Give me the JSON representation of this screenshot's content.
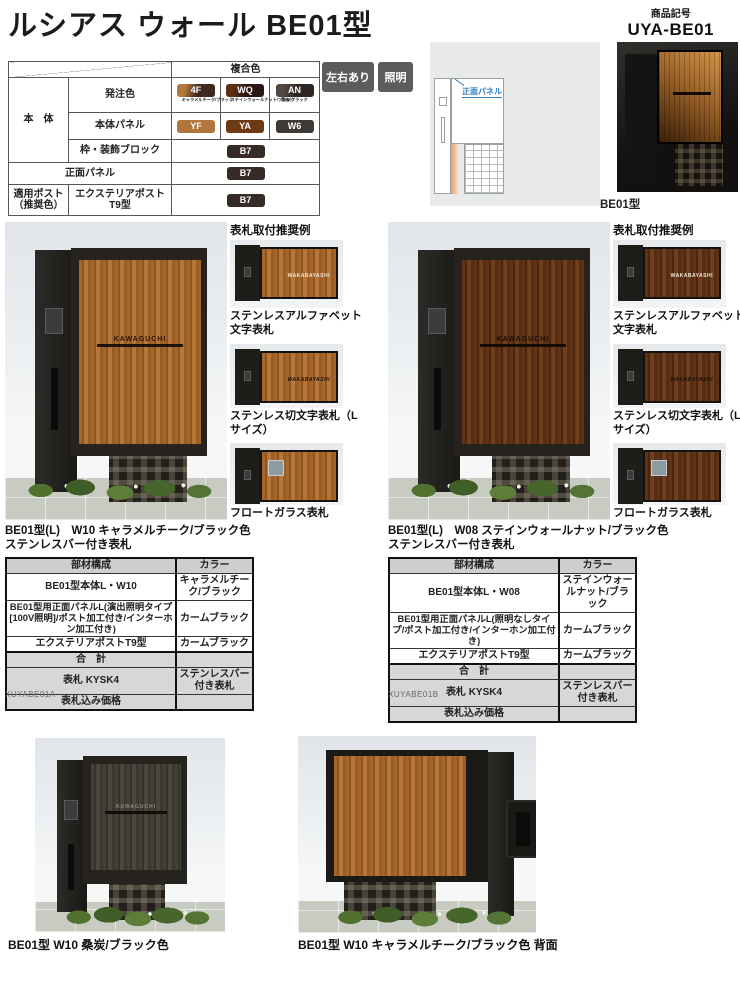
{
  "header": {
    "title": "ルシアス ウォール BE01型",
    "product_code_label": "商品記号",
    "product_code": "UYA-BE01"
  },
  "spec_table": {
    "composite_header": "複合色",
    "body_label": "本　体",
    "order_color_label": "発注色",
    "body_panel_label": "本体パネル",
    "frame_block_label": "枠・装飾ブロック",
    "front_panel_label": "正面パネル",
    "post_row_label": "適用ポスト（推奨色）",
    "post_model": "エクステリアポスト T9型",
    "order_colors": [
      {
        "code": "4F",
        "name": "キャラメルチーク/ブラック",
        "chip": "#3c2a1e"
      },
      {
        "code": "WQ",
        "name": "ステインウォールナット/ブラック",
        "chip": "#281712"
      },
      {
        "code": "AN",
        "name": "桑炭/ブラック",
        "chip": "#2e2724"
      }
    ],
    "panel_colors": [
      {
        "code": "YF",
        "chip": "#b0763c"
      },
      {
        "code": "YA",
        "chip": "#6e3a14"
      },
      {
        "code": "W6",
        "chip": "#3f3a36"
      }
    ],
    "block_color": {
      "code": "B7",
      "chip": "#362b26"
    }
  },
  "tags": [
    {
      "label": "左右あり"
    },
    {
      "label": "照明"
    }
  ],
  "lighting": {
    "diagram_label": "正面パネル",
    "title": "演出照明タイプ",
    "badge_100v": "100Vタイプ",
    "badge_100v_color": "#ef9350",
    "badge_24v": "24Vタイプ",
    "badge_24v_color": "#6cb52f"
  },
  "hero_caption": "BE01型",
  "nameplate_example_title": "表札取付推奨例",
  "nameplate_demo_text": "WAKABAYASHI",
  "photo_nameplate_text": "KAWAGUCHI",
  "sections": [
    {
      "caption_line1": "BE01型(L)　W10 キャラメルチーク/ブラック色",
      "caption_line2": "ステンレスバー付き表札",
      "thumbs": [
        "ステンレスアルファベット文字表札",
        "ステンレス切文字表札（Lサイズ）",
        "フロートガラス表札"
      ],
      "table": {
        "headers": [
          "部材構成",
          "カラー"
        ],
        "rows": [
          {
            "part": "BE01型本体L・W10",
            "color": "キャラメルチーク/ブラック"
          },
          {
            "part": "BE01型用正面パネルL(演出照明タイプ[100V照明]/ポスト加工付き/インターホン加工付き)",
            "color": "カームブラック"
          },
          {
            "part": "エクステリアポストT9型",
            "color": "カームブラック"
          },
          {
            "part": "合　計",
            "color": ""
          },
          {
            "part": "表札 KYSK4",
            "color": "ステンレスバー付き表札"
          },
          {
            "part": "表札込み価格",
            "color": ""
          }
        ],
        "code": "XUYABE01A"
      }
    },
    {
      "caption_line1": "BE01型(L)　W08 ステインウォールナット/ブラック色",
      "caption_line2": "ステンレスバー付き表札",
      "thumbs": [
        "ステンレスアルファベット文字表札",
        "ステンレス切文字表札（Lサイズ）",
        "フロートガラス表札"
      ],
      "table": {
        "headers": [
          "部材構成",
          "カラー"
        ],
        "rows": [
          {
            "part": "BE01型本体L・W08",
            "color": "ステインウォールナット/ブラック"
          },
          {
            "part": "BE01型用正面パネルL(照明なしタイプ/ポスト加工付き/インターホン加工付き)",
            "color": "カームブラック"
          },
          {
            "part": "エクステリアポストT9型",
            "color": "カームブラック"
          },
          {
            "part": "合　計",
            "color": ""
          },
          {
            "part": "表札 KYSK4",
            "color": "ステンレスバー付き表札"
          },
          {
            "part": "表札込み価格",
            "color": ""
          }
        ],
        "code": "XUYABE01B"
      }
    }
  ],
  "bottom_photos": [
    {
      "caption": "BE01型 W10 桑炭/ブラック色"
    },
    {
      "caption": "BE01型 W10 キャラメルチーク/ブラック色 背面"
    }
  ]
}
